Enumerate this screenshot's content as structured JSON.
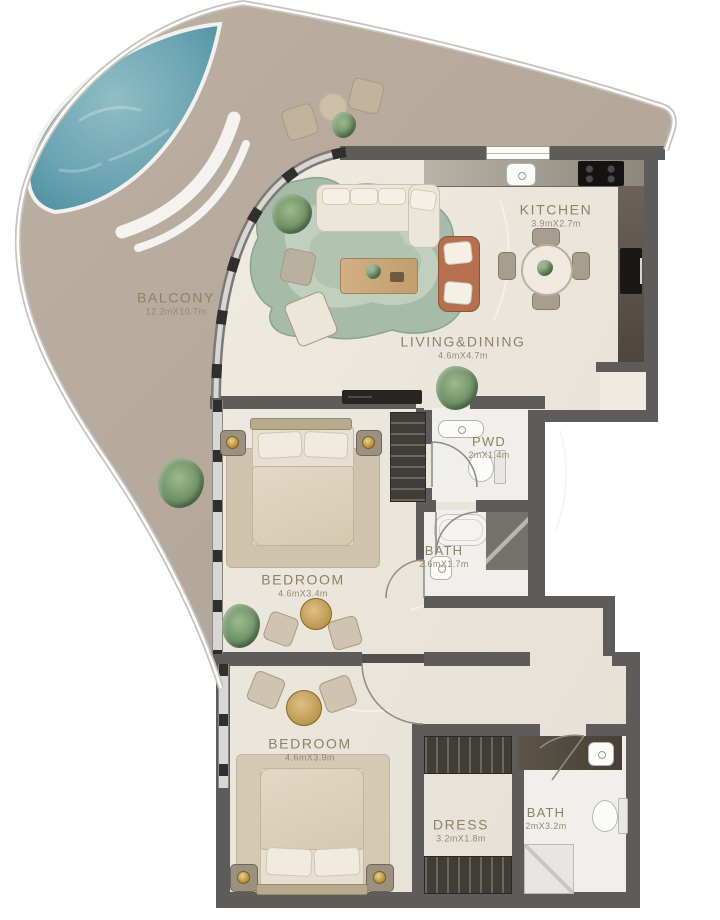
{
  "rooms": [
    {
      "id": "balcony",
      "label": "BALCONY",
      "dims": "12.2mX10.7m"
    },
    {
      "id": "kitchen",
      "label": "KITCHEN",
      "dims": "3.9mX2.7m"
    },
    {
      "id": "living",
      "label": "LIVING&DINING",
      "dims": "4.6mX4.7m"
    },
    {
      "id": "pwd",
      "label": "PWD",
      "dims": "2mX1.4m"
    },
    {
      "id": "bath1",
      "label": "BATH",
      "dims": "2.6mX1.7m"
    },
    {
      "id": "bedroom1",
      "label": "BEDROOM",
      "dims": "4.6mX3.4m"
    },
    {
      "id": "bedroom2",
      "label": "BEDROOM",
      "dims": "4.6mX3.9m"
    },
    {
      "id": "dress",
      "label": "DRESS",
      "dims": "3.2mX1.8m"
    },
    {
      "id": "bath2",
      "label": "BATH",
      "dims": "2mX3.2m"
    }
  ],
  "colors": {
    "floor": "#e9e4db",
    "balcony_floor": "#b6aa9d",
    "pool_water": "#5f9aab",
    "wall": "#5d5c5a",
    "label_text": "#8d8166",
    "deck_white": "#f4f3f0",
    "rug_green": "#a6bba9",
    "sofa_cream": "#ece6d9",
    "accent_terracotta": "#b5714f",
    "wood": "#c8a877",
    "greenery": "#7f9f7c",
    "gold": "#c6a14b"
  }
}
